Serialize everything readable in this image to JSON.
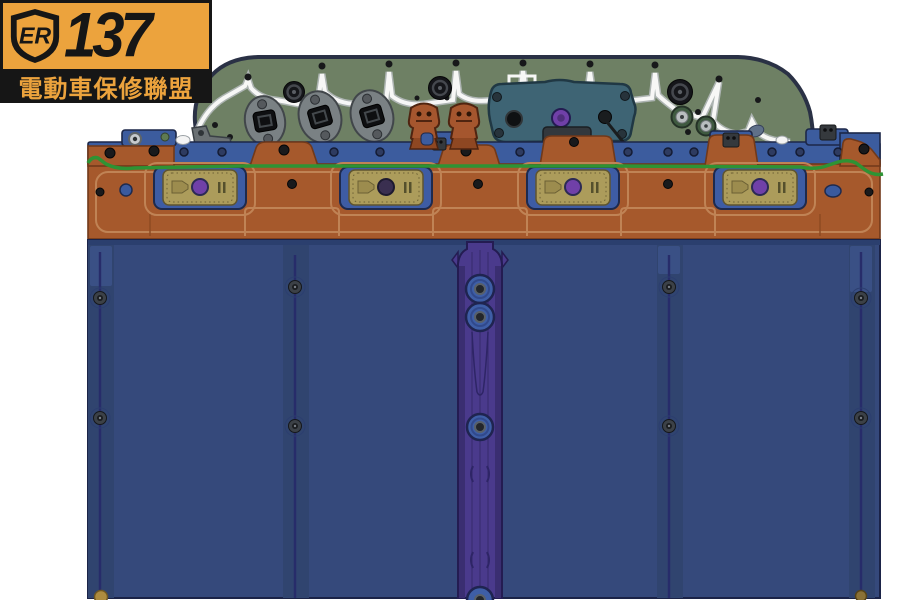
{
  "logo": {
    "shield_text": "ER",
    "number": "137",
    "subtitle": "電動車保修聯盟"
  },
  "colors": {
    "logo_yellow": "#ECA33D",
    "logo_black": "#161616",
    "housing_green": "#6E8064",
    "housing_outline": "#2A3145",
    "gasket_white": "#F7F7F6",
    "rail_blue": "#3C5C9E",
    "rail_outline": "#1C2748",
    "seal_green": "#2E9334",
    "beam_orange": "#A6592C",
    "beam_outline": "#71391A",
    "beam_highlight": "#C08355",
    "plate_tan": "#AC9C5B",
    "plate_outline": "#5F5530",
    "cutout_blue": "#3E5CA4",
    "fastener_purple": "#7040A8",
    "panel_blue": "#35497B",
    "panel_outline": "#1B2347",
    "seam_indigo": "#272C6A",
    "channel_purple": "#4A3A8C",
    "channel_edge": "#3A2E71",
    "channel_outline": "#241C52",
    "boss_blue": "#3E5EA6",
    "teal_panel": "#3E6474",
    "teal_outline": "#203844",
    "copper": "#A5562E",
    "copper_outline": "#4F2410",
    "mount_gray": "#7A8184",
    "mount_outline": "#41464A",
    "gold": "#AD8C3F"
  }
}
